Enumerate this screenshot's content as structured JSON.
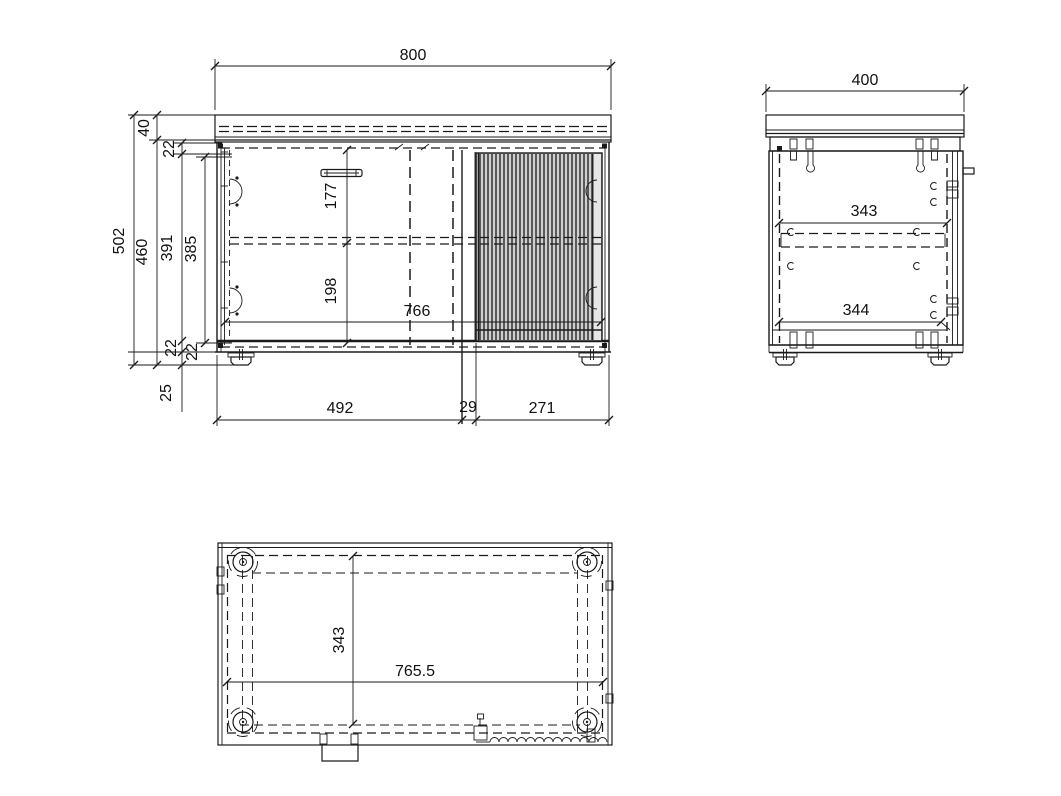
{
  "front_view": {
    "width": "800",
    "top_thickness": "40",
    "top_rail": "22",
    "overall_height": "502",
    "carcass_height": "460",
    "door_height": "391",
    "interior_height": "385",
    "handle_spacing": "177",
    "shelf_spacing": "198",
    "interior_width": "766",
    "bottom_rail": "22",
    "base_rail": "22",
    "foot_height": "25",
    "left_section_width": "492",
    "divider_width": "29",
    "right_section_width": "271"
  },
  "side_view": {
    "depth": "400",
    "shelf_depth": "343",
    "bottom_depth": "344"
  },
  "bottom_view": {
    "foot_pitch_depth": "343",
    "foot_pitch_width": "765.5"
  }
}
